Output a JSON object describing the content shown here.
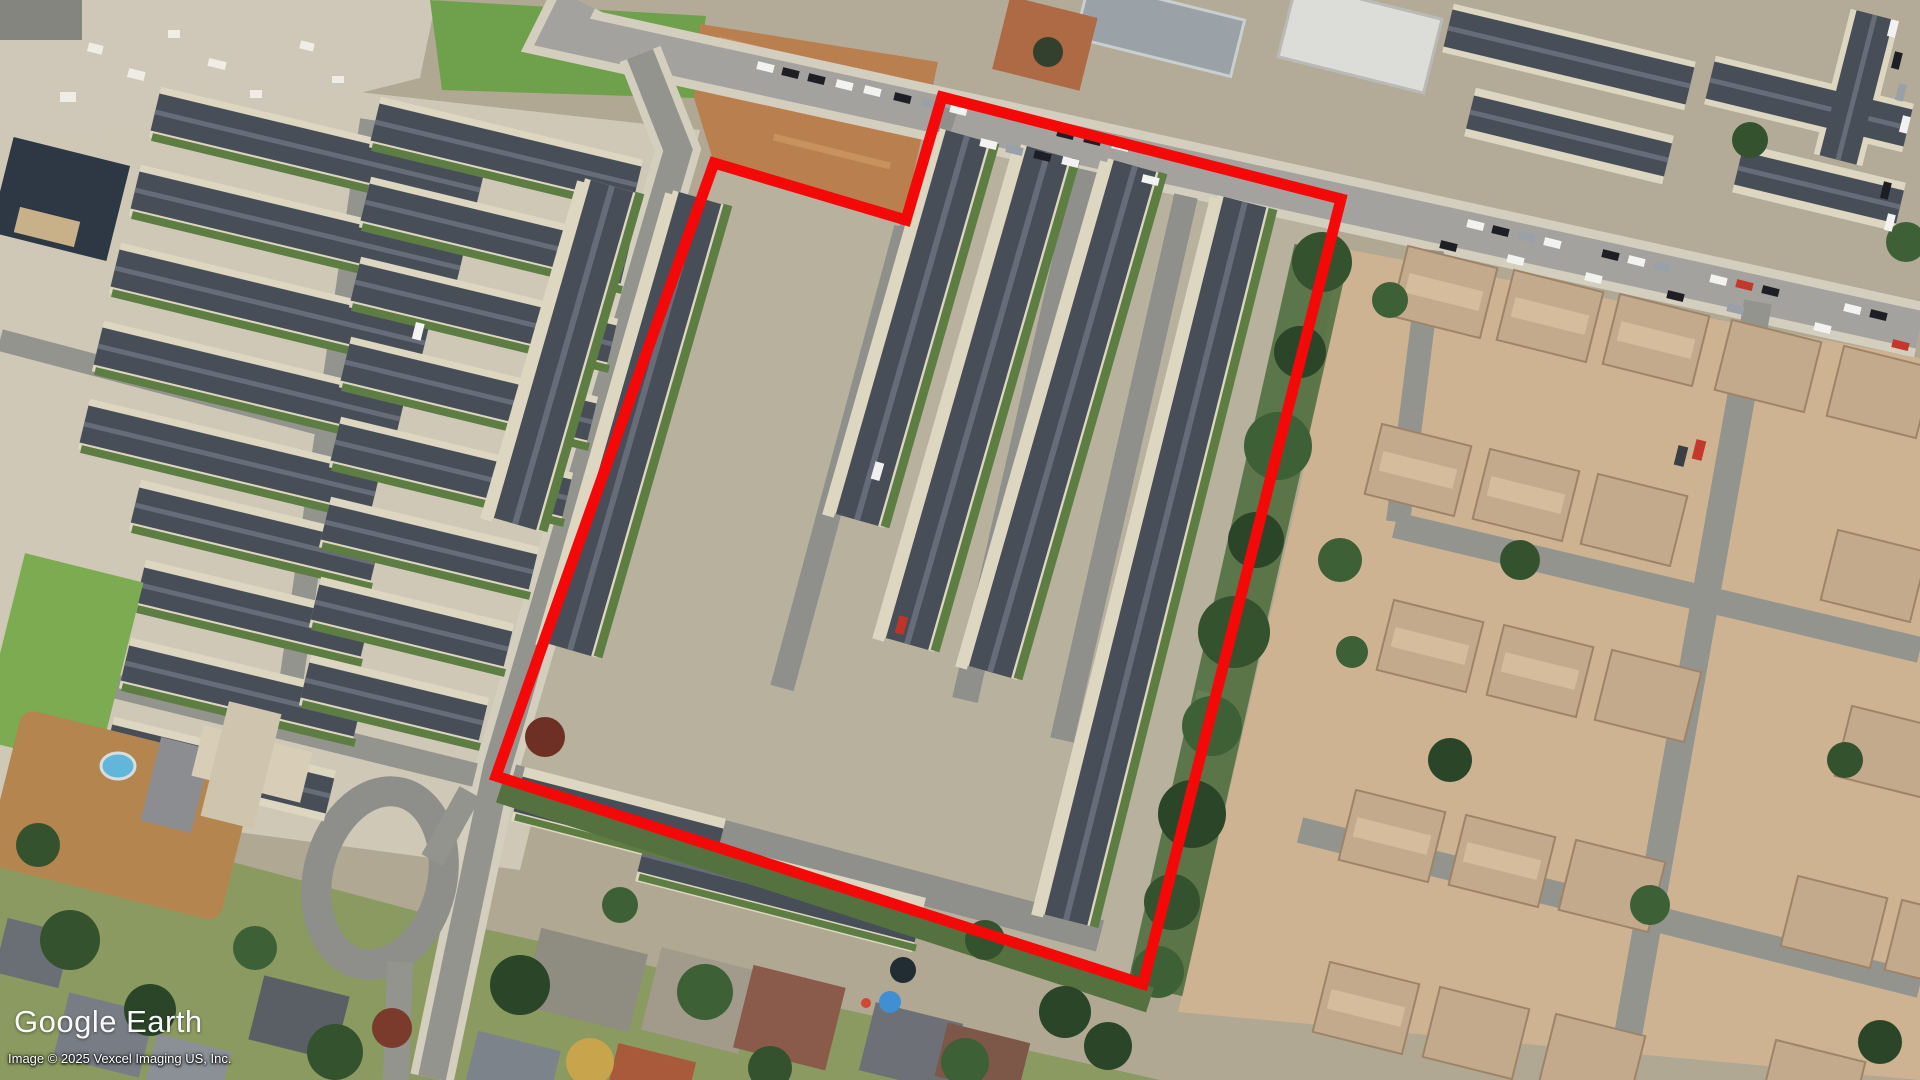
{
  "app": {
    "name": "Google Earth"
  },
  "watermark": {
    "logo": "Google Earth",
    "copyright": "Image © 2025 Vexcel Imaging US, Inc."
  },
  "annotation": {
    "type": "parcel-outline-polygon",
    "points": "942,97 1341,199 1143,984 496,776 714,163 906,220",
    "stroke": "#f50808",
    "stroke_width": 11
  },
  "scene": {
    "imagery": "aerial-satellite",
    "accent_colors": {
      "dark_townhouse_roof": "#484e58",
      "tan_house_roof": "#c4aa8d",
      "road": "#a3a29e",
      "vegetation": "#4c6c3c",
      "dirt_field": "#b97f4e"
    }
  }
}
